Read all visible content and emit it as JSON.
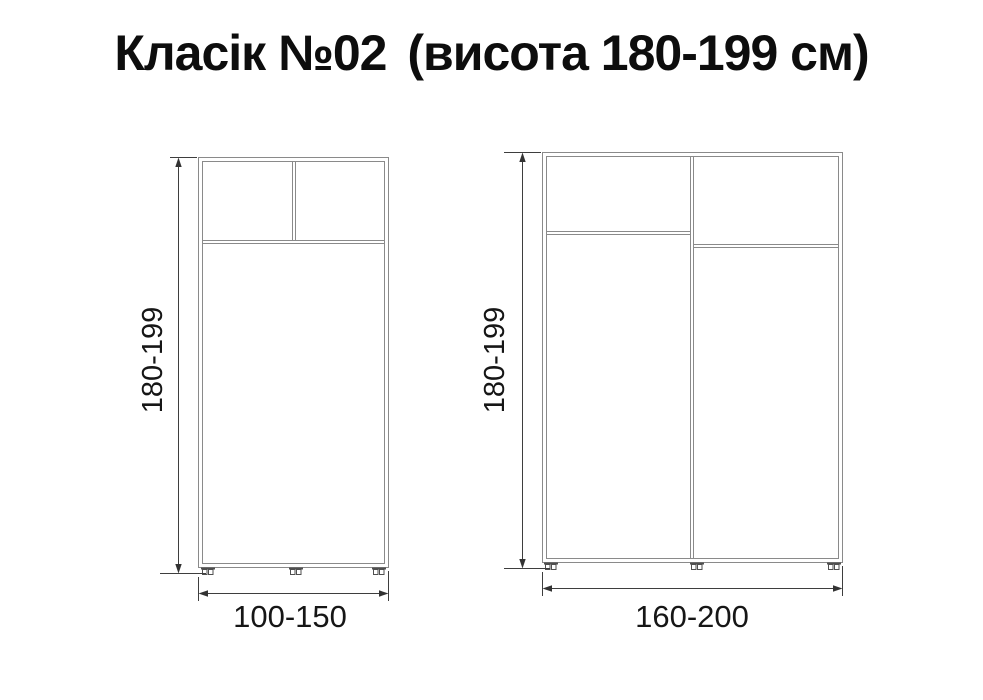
{
  "title": {
    "main": "Класік №02",
    "sub": "(висота 180-199 см)"
  },
  "diagram": {
    "left_unit": {
      "height_label": "180-199",
      "width_label": "100-150"
    },
    "right_unit": {
      "height_label": "180-199",
      "width_label": "160-200"
    }
  },
  "colors": {
    "background": "#ffffff",
    "cabinet_line": "#8a8a8a",
    "dimension_line": "#3e3e3e",
    "text": "#0d0d0d"
  }
}
